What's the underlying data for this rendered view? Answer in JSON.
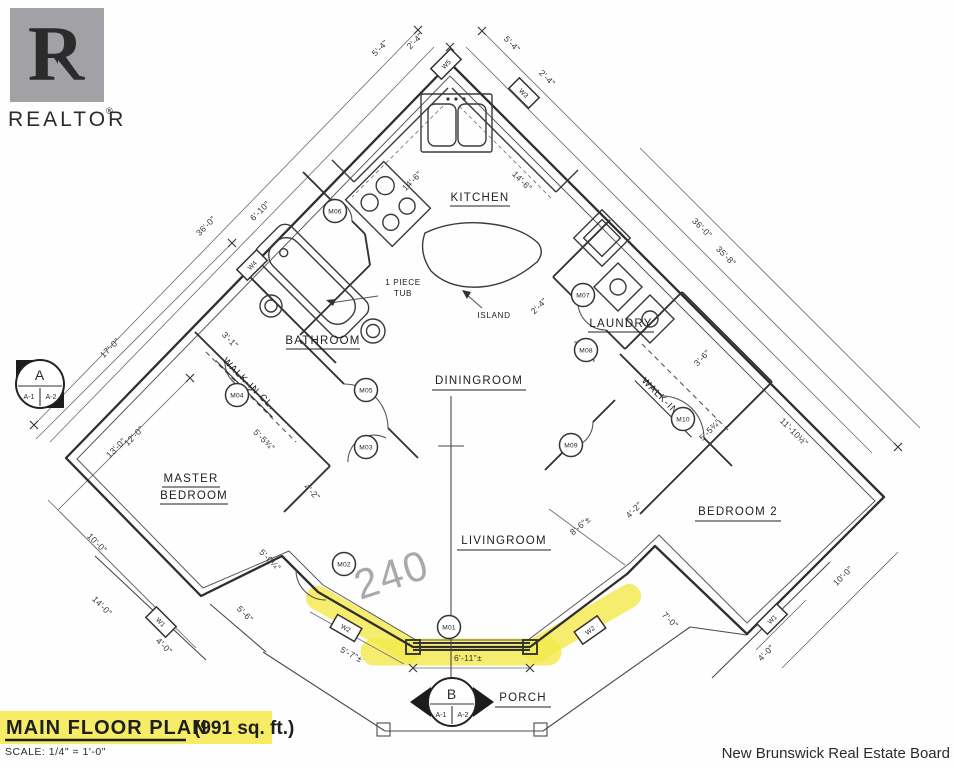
{
  "logo": {
    "letter": "R",
    "brand": "REALTOR",
    "registered": "®"
  },
  "title": {
    "main": "MAIN FLOOR PLAN",
    "area": "(991 sq. ft.)",
    "scale": "SCALE: 1/4\" = 1'-0\""
  },
  "attribution": "New Brunswick Real Estate Board",
  "annotation_pencil": "240",
  "colors": {
    "highlight": "#f4e94b",
    "ink": "#2e2e2e",
    "pencil_gray": "#9b9b9b",
    "logo_gray": "#a2a1a6",
    "attribution_gray": "#bdbdbd"
  },
  "plan": {
    "rooms": {
      "kitchen": "KITCHEN",
      "laundry": "LAUNDRY",
      "bathroom": "BATHROOM",
      "dining": "DININGROOM",
      "living": "LIVINGROOM",
      "master_line1": "MASTER",
      "master_line2": "BEDROOM",
      "bedroom2": "BEDROOM 2",
      "walkin_left": "WALK-IN CL.",
      "walkin_right": "WALK-IN CL.",
      "porch": "PORCH",
      "island": "ISLAND",
      "tub_line1": "1 PIECE",
      "tub_line2": "TUB"
    },
    "doors": [
      {
        "label": "M01"
      },
      {
        "label": "M02"
      },
      {
        "label": "M03"
      },
      {
        "label": "M04"
      },
      {
        "label": "M05"
      },
      {
        "label": "M06"
      },
      {
        "label": "M07"
      },
      {
        "label": "M08"
      },
      {
        "label": "M09"
      },
      {
        "label": "M10"
      }
    ],
    "windows": [
      {
        "label": "W5"
      },
      {
        "label": "W3"
      },
      {
        "label": "W4"
      },
      {
        "label": "W1"
      },
      {
        "label": "W2"
      },
      {
        "label": "W2"
      },
      {
        "label": "W1"
      }
    ],
    "dims": [
      {
        "t": "5'-4\""
      },
      {
        "t": "2'-4\""
      },
      {
        "t": "5'-4\""
      },
      {
        "t": "2'-4\""
      },
      {
        "t": "14'-6\""
      },
      {
        "t": "14'-6\""
      },
      {
        "t": "6'-10\""
      },
      {
        "t": "36'-0\""
      },
      {
        "t": "17'-0\""
      },
      {
        "t": "13'-0\""
      },
      {
        "t": "36'-0\""
      },
      {
        "t": "35'-8\""
      },
      {
        "t": "12'-0\""
      },
      {
        "t": "10'-0\""
      },
      {
        "t": "14'-0\""
      },
      {
        "t": "4'-0\""
      },
      {
        "t": "5'-6\""
      },
      {
        "t": "5'-0¼\""
      },
      {
        "t": "5'-5¾\""
      },
      {
        "t": "4'-2\""
      },
      {
        "t": "3'-1\""
      },
      {
        "t": "5'-7\"±"
      },
      {
        "t": "6'-11\"±"
      },
      {
        "t": "8'-6\"±"
      },
      {
        "t": "4'-2\""
      },
      {
        "t": "5'-5¾\""
      },
      {
        "t": "3'-6\""
      },
      {
        "t": "11'-10½\""
      },
      {
        "t": "10'-0\""
      },
      {
        "t": "7'-0\""
      },
      {
        "t": "4'-0\""
      },
      {
        "t": "2'-4\""
      }
    ],
    "markers": {
      "a": {
        "label": "A",
        "sub1": "A-1",
        "sub2": "A-2"
      },
      "b": {
        "label": "B",
        "sub1": "A-1",
        "sub2": "A-2"
      }
    }
  }
}
